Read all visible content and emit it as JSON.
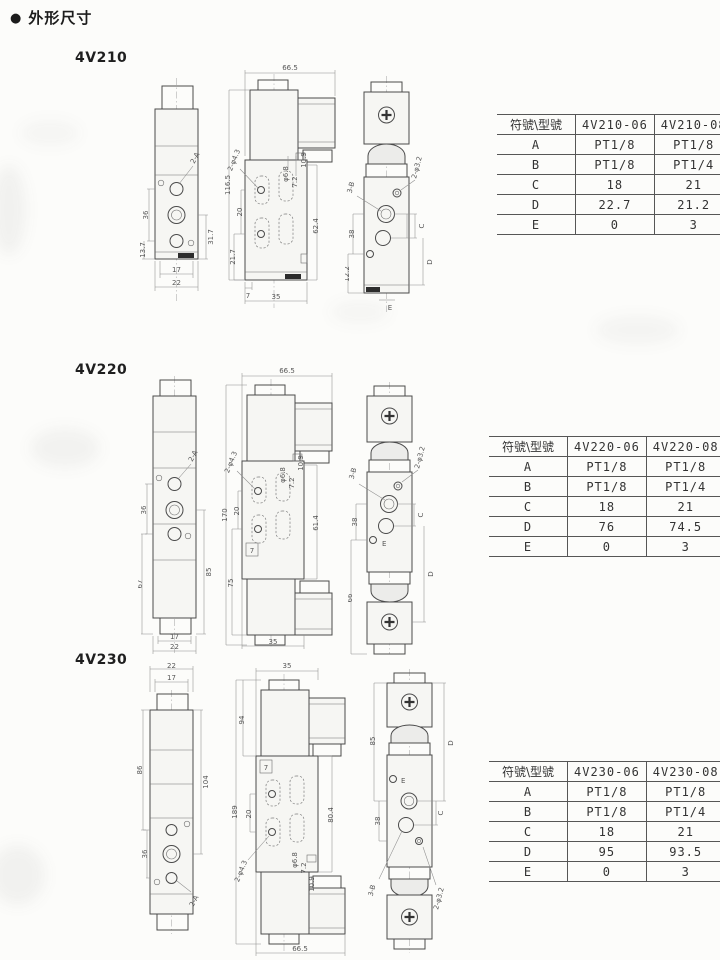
{
  "page": {
    "bullet": "●",
    "title": "外形尺寸"
  },
  "sections": [
    {
      "model": "4V210",
      "table": {
        "col_headers": [
          "符號\\型號",
          "4V210-06",
          "4V210-08"
        ],
        "rows": [
          {
            "sym": "A",
            "v06": "PT1/8",
            "v08": "PT1/8"
          },
          {
            "sym": "B",
            "v06": "PT1/8",
            "v08": "PT1/4"
          },
          {
            "sym": "C",
            "v06": "18",
            "v08": "21"
          },
          {
            "sym": "D",
            "v06": "22.7",
            "v08": "21.2"
          },
          {
            "sym": "E",
            "v06": "0",
            "v08": "3"
          }
        ]
      },
      "front": {
        "ports": "2-A",
        "h1": "36",
        "h2": "13.7",
        "h3": "31.7",
        "w1": "17",
        "w2": "22"
      },
      "side": {
        "w": "66.5",
        "total": "116.5",
        "holes": "2-φ4.3",
        "p1": "20",
        "p2": "21.7",
        "base": "7",
        "wb": "35",
        "hole_d": "φ6.8",
        "hole_off": "7.2",
        "conn": "10.9",
        "h": "62.4"
      },
      "end": {
        "ports": "3-B",
        "pilot": "2-φ3.2",
        "h1": "38",
        "h2": "12.2",
        "c": "C",
        "d": "D",
        "e": "E"
      }
    },
    {
      "model": "4V220",
      "table": {
        "col_headers": [
          "符號\\型號",
          "4V220-06",
          "4V220-08"
        ],
        "rows": [
          {
            "sym": "A",
            "v06": "PT1/8",
            "v08": "PT1/8"
          },
          {
            "sym": "B",
            "v06": "PT1/8",
            "v08": "PT1/4"
          },
          {
            "sym": "C",
            "v06": "18",
            "v08": "21"
          },
          {
            "sym": "D",
            "v06": "76",
            "v08": "74.5"
          },
          {
            "sym": "E",
            "v06": "0",
            "v08": "3"
          }
        ]
      },
      "front": {
        "ports": "2-A",
        "h1": "36",
        "h2": "67",
        "h3": "85",
        "w1": "17",
        "w2": "22"
      },
      "side": {
        "w": "66.5",
        "total": "170",
        "holes": "2-φ4.3",
        "p1": "20",
        "p2": "75",
        "base": "7",
        "wb": "35",
        "hole_d": "φ6.8",
        "hole_off": "7.2",
        "conn": "10.9",
        "h": "61.4"
      },
      "end": {
        "ports": "3-B",
        "pilot": "2-φ3.2",
        "h1": "38",
        "h2": "66",
        "c": "C",
        "d": "D",
        "e": "E"
      }
    },
    {
      "model": "4V230",
      "table": {
        "col_headers": [
          "符號\\型號",
          "4V230-06",
          "4V230-08"
        ],
        "rows": [
          {
            "sym": "A",
            "v06": "PT1/8",
            "v08": "PT1/8"
          },
          {
            "sym": "B",
            "v06": "PT1/8",
            "v08": "PT1/4"
          },
          {
            "sym": "C",
            "v06": "18",
            "v08": "21"
          },
          {
            "sym": "D",
            "v06": "95",
            "v08": "93.5"
          },
          {
            "sym": "E",
            "v06": "0",
            "v08": "3"
          }
        ]
      },
      "front": {
        "ports": "2-A",
        "w1": "22",
        "w2": "17",
        "h1": "86",
        "h2": "36",
        "h3": "104"
      },
      "side": {
        "w": "35",
        "wb": "66.5",
        "total": "189",
        "top": "94",
        "holes": "2-φ4.3",
        "p1": "20",
        "base": "7",
        "hole_d": "φ6.8",
        "hole_off": "7.2",
        "conn": "10.9",
        "h": "80.4"
      },
      "end": {
        "ports": "3-B",
        "pilot": "2-φ3.2",
        "h1": "85",
        "h2": "38",
        "c": "C",
        "d": "D",
        "e": "E"
      }
    }
  ]
}
